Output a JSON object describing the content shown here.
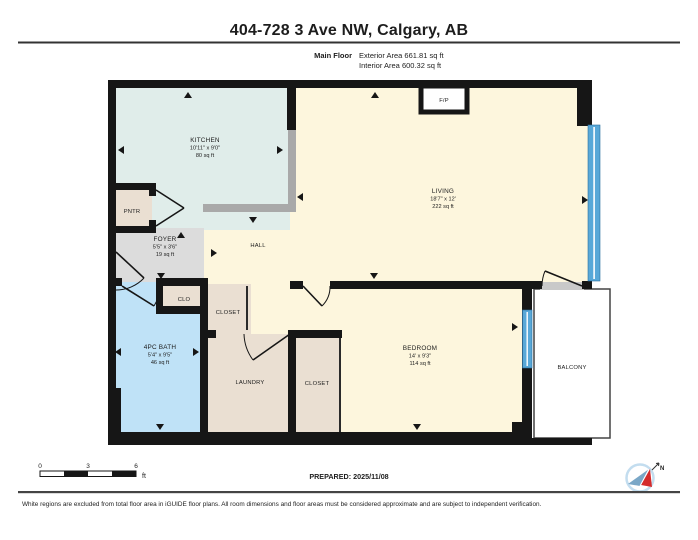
{
  "header": {
    "title": "404-728 3 Ave NW, Calgary, AB",
    "floor_label": "Main Floor",
    "exterior_area": "Exterior Area 661.81 sq ft",
    "interior_area": "Interior Area 600.32 sq ft"
  },
  "rooms": {
    "kitchen": {
      "name": "KITCHEN",
      "dims": "10'11\" x 9'0\"",
      "area": "80 sq ft"
    },
    "living": {
      "name": "LIVING",
      "dims": "18'7\" x 12'",
      "area": "222 sq ft"
    },
    "foyer": {
      "name": "FOYER",
      "dims": "5'5\" x 3'6\"",
      "area": "19 sq ft"
    },
    "bath": {
      "name": "4PC BATH",
      "dims": "5'4\" x 9'5\"",
      "area": "46 sq ft"
    },
    "bedroom": {
      "name": "BEDROOM",
      "dims": "14' x 9'3\"",
      "area": "114 sq ft"
    },
    "hall": {
      "name": "HALL"
    },
    "pantry": {
      "name": "PNTR"
    },
    "clo": {
      "name": "CLO"
    },
    "closet_upper": {
      "name": "CLOSET"
    },
    "closet_lower": {
      "name": "CLOSET"
    },
    "laundry": {
      "name": "LAUNDRY"
    },
    "balcony": {
      "name": "BALCONY"
    },
    "fireplace": {
      "name": "F/P"
    }
  },
  "scale_bar": {
    "tick_0": "0",
    "tick_3": "3",
    "tick_6": "6",
    "unit": "ft"
  },
  "prepared_label": "PREPARED: 2025/11/08",
  "north_indicator": "N",
  "disclaimer": "White regions are excluded from total floor area in iGUIDE floor plans. All room dimensions and floor areas must be considered approximate and are subject to independent verification.",
  "colors": {
    "wall": "#161616",
    "room_cream": "#fdf6dd",
    "kitchen_teal": "#e0edea",
    "closet_tan": "#eadfd2",
    "foyer_gray": "#dcdcdc",
    "bath_blue": "#bfe2f7",
    "window_blue": "#58a8d8",
    "counter_gray": "#a9a9a9"
  }
}
